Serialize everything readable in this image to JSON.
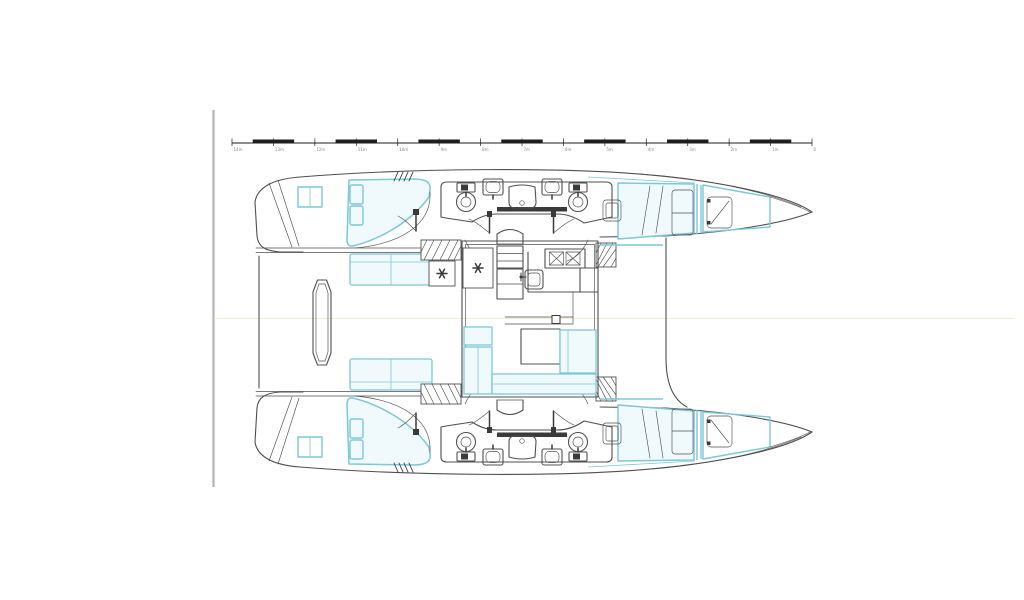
{
  "meta": {
    "description": "Catamaran sailboat deck and accommodation plan, top view, bow to the right: two hulls each with aft double cabin, two bathrooms with toilets and sinks, shared shower, forward double cabin and forepeak berth; central salon with galley, stove, sink, dining table and U-shaped sofa; cockpit benches, transom steps and boarding platform aft; scale bar at top."
  },
  "colors": {
    "line": "#4f4f4f",
    "accent": "#7cc8d6",
    "accent_fill": "#f0f9fb",
    "dark": "#3a3a3a",
    "border": "#b3b3b3",
    "faint": "#f3eedb",
    "background": "#ffffff",
    "ruler_ink": "#1e1e1e",
    "ruler_label": "#8a8a8a"
  },
  "ruler": {
    "unit_labels": [
      "14m",
      "13m",
      "12m",
      "11m",
      "10m",
      "9m",
      "8m",
      "7m",
      "6m",
      "5m",
      "4m",
      "3m",
      "2m",
      "1m",
      "0"
    ],
    "divisions": 14
  },
  "components": {
    "hulls": [
      "hull-port",
      "hull-starboard"
    ],
    "per_hull": [
      "transom-steps",
      "transom-seat",
      "aft-cabin-bed",
      "bathroom-toilet",
      "bathroom-sink",
      "shower-tray",
      "companionway-steps",
      "forward-cabin-bed",
      "forepeak-berth",
      "deck-hatch"
    ],
    "bridgedeck": [
      "cockpit-bench",
      "boarding-platform",
      "salon-walls",
      "galley-counter",
      "stove-symbol",
      "galley-sink",
      "dining-table",
      "u-sofa",
      "fan-hatch",
      "forward-beam"
    ],
    "symbol_counts": {
      "toilets": 4,
      "sinks_bathroom": 4,
      "showers": 2,
      "beds": 6,
      "fan_hatches": 2
    }
  }
}
